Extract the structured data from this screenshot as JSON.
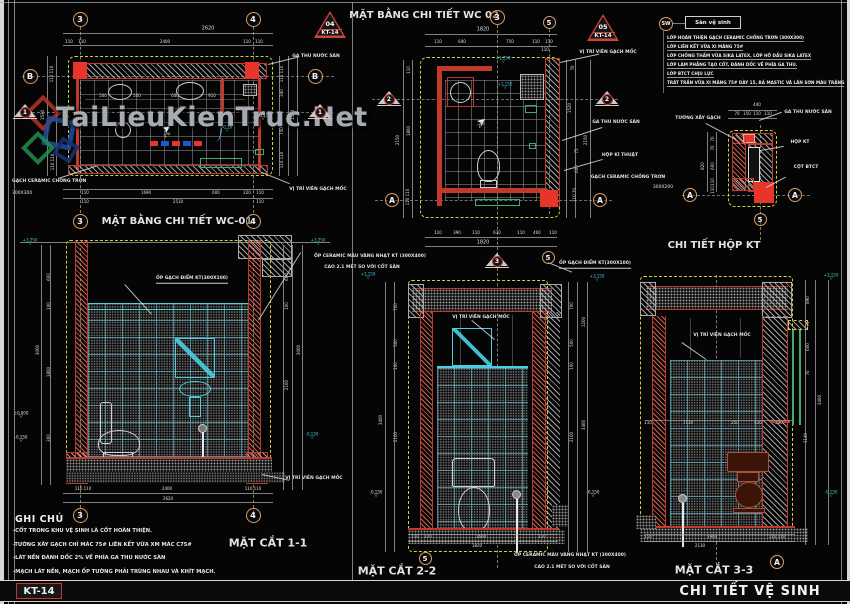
{
  "meta": {
    "sheet_code": "KT-14",
    "sheet_title": "CHI TIẾT VỆ SINH"
  },
  "watermark": {
    "text": "TaiLieuKienTruc.Net"
  },
  "legend": {
    "tag": "SW",
    "box_label": "Sàn vệ sinh",
    "lines": [
      "LỚP HOÀN THIỆN GẠCH CERAMIC CHỐNG TRƠN (300X300)",
      "LỚP LIÊN KẾT VỮA XI MĂNG 75#",
      "LỚP CHỐNG THẤM VỮA SIKA LATEX, LỚP HỒ DẦU SIKA LATEX",
      "LỚP LÀM PHẲNG TẠO CỐT, ĐÁNH DỐC VỀ PHÍA GA THU.",
      "LỚP BTCT CHỊU LỰC",
      "TRÁT TRẦN VỮA XI MĂNG 75# DÀY 15, BẢ MASTIC VÀ LĂN SƠN MÀU TRẮNG"
    ]
  },
  "notes": {
    "heading": "GHI CHÚ",
    "items": [
      "-CỐT TRONG KHU VỆ SINH LÀ CỐT HOÀN THIỆN.",
      "-TƯỜNG XÂY GẠCH CHỈ MÁC 75# LIÊN KẾT VỮA XM MÁC C75#",
      "-LÁT NỀN ĐÁNH DỐC 2% VỀ PHÍA GA THU NƯỚC SÀN",
      "-MẠCH LÁT NỀN, MẠCH ỐP TƯỜNG PHẢI TRÙNG NHAU VÀ KHÍT MẠCH."
    ]
  },
  "bubbles": [
    {
      "k": "c",
      "t": "3",
      "x": 80,
      "y": 19,
      "d": 15
    },
    {
      "k": "c",
      "t": "4",
      "x": 253,
      "y": 19,
      "d": 15
    },
    {
      "k": "c",
      "t": "B",
      "x": 30,
      "y": 76,
      "d": 15
    },
    {
      "k": "c",
      "t": "B",
      "x": 315,
      "y": 76,
      "d": 15
    },
    {
      "k": "c",
      "t": "3",
      "x": 80,
      "y": 221,
      "d": 15
    },
    {
      "k": "c",
      "t": "4",
      "x": 253,
      "y": 221,
      "d": 15
    },
    {
      "k": "t",
      "t": "1",
      "x": 25,
      "y": 112
    },
    {
      "k": "t",
      "t": "1",
      "x": 320,
      "y": 112
    },
    {
      "k": "r",
      "no": "04",
      "sheet": "KT-14",
      "x": 330,
      "y": 24
    },
    {
      "k": "c",
      "t": "3",
      "x": 497,
      "y": 17,
      "d": 15
    },
    {
      "k": "c",
      "t": "5",
      "x": 549,
      "y": 22,
      "d": 13
    },
    {
      "k": "r",
      "no": "05",
      "sheet": "KT-14",
      "x": 603,
      "y": 27
    },
    {
      "k": "t",
      "t": "2",
      "x": 389,
      "y": 99
    },
    {
      "k": "t",
      "t": "2",
      "x": 607,
      "y": 99
    },
    {
      "k": "c",
      "t": "A",
      "x": 392,
      "y": 200,
      "d": 14
    },
    {
      "k": "c",
      "t": "A",
      "x": 600,
      "y": 200,
      "d": 14
    },
    {
      "k": "c",
      "t": "A",
      "x": 690,
      "y": 195,
      "d": 14
    },
    {
      "k": "c",
      "t": "A",
      "x": 795,
      "y": 195,
      "d": 14
    },
    {
      "k": "c",
      "t": "5",
      "x": 760,
      "y": 219,
      "d": 13
    },
    {
      "k": "c",
      "t": "3",
      "x": 80,
      "y": 515,
      "d": 15
    },
    {
      "k": "c",
      "t": "4",
      "x": 253,
      "y": 515,
      "d": 15
    },
    {
      "k": "t",
      "t": "3",
      "x": 497,
      "y": 261
    },
    {
      "k": "c",
      "t": "5",
      "x": 548,
      "y": 257,
      "d": 13
    },
    {
      "k": "c",
      "t": "5",
      "x": 425,
      "y": 558,
      "d": 13
    },
    {
      "k": "c",
      "t": "A",
      "x": 777,
      "y": 562,
      "d": 14
    }
  ],
  "annotations": [
    {
      "t": "MẶT BẰNG CHI TIẾT WC-01",
      "x": 177,
      "y": 222,
      "s": 10,
      "b": 1,
      "n": "title-plan-wc01"
    },
    {
      "t": "2620",
      "x": 208,
      "y": 29
    },
    {
      "t": "110",
      "x": 69,
      "y": 42,
      "s": 4
    },
    {
      "t": "110",
      "x": 82,
      "y": 42,
      "s": 4
    },
    {
      "t": "2400",
      "x": 165,
      "y": 42,
      "s": 4
    },
    {
      "t": "110",
      "x": 247,
      "y": 42,
      "s": 4
    },
    {
      "t": "110",
      "x": 259,
      "y": 42,
      "s": 4
    },
    {
      "t": "500",
      "x": 103,
      "y": 96,
      "s": 4
    },
    {
      "t": "500",
      "x": 137,
      "y": 96,
      "s": 4
    },
    {
      "t": "600",
      "x": 175,
      "y": 96,
      "s": 4
    },
    {
      "t": "910",
      "x": 212,
      "y": 96,
      "s": 4
    },
    {
      "t": "110 110",
      "x": 52,
      "y": 74,
      "s": 4,
      "r": -90
    },
    {
      "t": "1530",
      "x": 43,
      "y": 115,
      "s": 4,
      "r": -90
    },
    {
      "t": "110 110",
      "x": 53,
      "y": 162,
      "s": 4,
      "r": -90
    },
    {
      "t": "110 110",
      "x": 282,
      "y": 74,
      "s": 4,
      "r": -90
    },
    {
      "t": "340",
      "x": 282,
      "y": 93,
      "s": 4,
      "r": -90
    },
    {
      "t": "1530",
      "x": 293,
      "y": 115,
      "s": 4,
      "r": -90
    },
    {
      "t": "750",
      "x": 282,
      "y": 131,
      "s": 4,
      "r": -90
    },
    {
      "t": "110 110",
      "x": 282,
      "y": 160,
      "s": 4,
      "r": -90
    },
    {
      "t": "110",
      "x": 85,
      "y": 193,
      "s": 4
    },
    {
      "t": "1690",
      "x": 146,
      "y": 193,
      "s": 4
    },
    {
      "t": "600",
      "x": 216,
      "y": 193,
      "s": 4
    },
    {
      "t": "220",
      "x": 247,
      "y": 193,
      "s": 4
    },
    {
      "t": "110",
      "x": 260,
      "y": 193,
      "s": 4
    },
    {
      "t": "110",
      "x": 85,
      "y": 202,
      "s": 4
    },
    {
      "t": "2510",
      "x": 178,
      "y": 202,
      "s": 4
    },
    {
      "t": "110",
      "x": 260,
      "y": 202,
      "s": 4
    },
    {
      "t": "GA THU NƯỚC SÀN",
      "x": 316,
      "y": 57,
      "s": 4.5,
      "b": 1,
      "n": "label-ga-thu-nuoc-san"
    },
    {
      "t": "GẠCH CERAMIC CHỐNG TRƠN",
      "x": 12,
      "y": 182,
      "s": 4.5,
      "b": 1,
      "a": "l",
      "n": "label-gach-ceramic"
    },
    {
      "t": "300X300",
      "x": 12,
      "y": 194,
      "s": 4.5,
      "a": "l"
    },
    {
      "t": "VỊ TRÍ VIÊN GẠCH MỐC",
      "x": 318,
      "y": 190,
      "s": 4.5,
      "b": 1,
      "n": "label-vien-gach-moc"
    },
    {
      "t": "-0.20",
      "x": 227,
      "y": 129,
      "s": 4,
      "c": "c",
      "lv": 1
    },
    {
      "t": "-0.15",
      "x": 263,
      "y": 117,
      "s": 4,
      "lv": 1
    },
    {
      "t": "2%",
      "x": 168,
      "y": 136,
      "s": 4.5,
      "r": -35
    },
    {
      "t": "MẶT BẰNG CHI TIẾT WC 02",
      "x": 424,
      "y": 16,
      "s": 10,
      "b": 1,
      "n": "title-plan-wc02"
    },
    {
      "t": "1820",
      "x": 483,
      "y": 30
    },
    {
      "t": "110",
      "x": 438,
      "y": 42,
      "s": 4
    },
    {
      "t": "640",
      "x": 462,
      "y": 42,
      "s": 4
    },
    {
      "t": "750",
      "x": 510,
      "y": 42,
      "s": 4
    },
    {
      "t": "110",
      "x": 536,
      "y": 42,
      "s": 4
    },
    {
      "t": "110",
      "x": 549,
      "y": 42,
      "s": 4
    },
    {
      "t": "110",
      "x": 545,
      "y": 50,
      "s": 4
    },
    {
      "t": "110",
      "x": 409,
      "y": 70,
      "s": 4,
      "r": -90
    },
    {
      "t": "1800",
      "x": 409,
      "y": 131,
      "s": 4,
      "r": -90
    },
    {
      "t": "2150",
      "x": 398,
      "y": 140,
      "s": 4,
      "r": -90
    },
    {
      "t": "110 110",
      "x": 408,
      "y": 197,
      "s": 4,
      "r": -90
    },
    {
      "t": "70",
      "x": 573,
      "y": 68,
      "s": 4,
      "r": -90
    },
    {
      "t": "1520",
      "x": 570,
      "y": 108,
      "s": 4,
      "r": -90
    },
    {
      "t": "2150",
      "x": 586,
      "y": 140,
      "s": 4,
      "r": -90
    },
    {
      "t": "75",
      "x": 577,
      "y": 151,
      "s": 4,
      "r": -90
    },
    {
      "t": "600",
      "x": 577,
      "y": 169,
      "s": 4,
      "r": -90
    },
    {
      "t": "110 70",
      "x": 575,
      "y": 195,
      "s": 4,
      "r": -90
    },
    {
      "t": "110",
      "x": 438,
      "y": 233,
      "s": 4
    },
    {
      "t": "390",
      "x": 457,
      "y": 233,
      "s": 4
    },
    {
      "t": "110",
      "x": 476,
      "y": 233,
      "s": 4
    },
    {
      "t": "630",
      "x": 497,
      "y": 233,
      "s": 4
    },
    {
      "t": "110",
      "x": 521,
      "y": 233,
      "s": 4
    },
    {
      "t": "400",
      "x": 537,
      "y": 233,
      "s": 4
    },
    {
      "t": "110",
      "x": 553,
      "y": 233,
      "s": 4
    },
    {
      "t": "1820",
      "x": 483,
      "y": 243
    },
    {
      "t": "+1.750",
      "x": 503,
      "y": 60,
      "s": 4,
      "c": "c",
      "lv": 1
    },
    {
      "t": "+1.150",
      "x": 505,
      "y": 86,
      "s": 4,
      "c": "c",
      "lv": 1
    },
    {
      "t": "VỊ TRÍ VIÊN GẠCH MỐC",
      "x": 608,
      "y": 53,
      "s": 4.5,
      "b": 1,
      "n": "label-vien-gach-moc"
    },
    {
      "t": "GA THU NƯỚC SÀN",
      "x": 616,
      "y": 123,
      "s": 4.5,
      "b": 1,
      "n": "label-ga-thu-nuoc-san"
    },
    {
      "t": "HỘP KĨ THUẬT",
      "x": 620,
      "y": 156,
      "s": 4.5,
      "b": 1,
      "n": "label-hop-ki-thuat"
    },
    {
      "t": "GẠCH CERAMIC CHỐNG TRƠN",
      "x": 628,
      "y": 178,
      "s": 4.5,
      "b": 1,
      "n": "label-gach-ceramic"
    },
    {
      "t": "300X200",
      "x": 663,
      "y": 188,
      "s": 4.5
    },
    {
      "t": "2%",
      "x": 482,
      "y": 126,
      "s": 4.5,
      "r": -40
    },
    {
      "t": "CHI TIẾT HỘP KT",
      "x": 714,
      "y": 246,
      "s": 10,
      "b": 1,
      "n": "title-detail-hop-kt"
    },
    {
      "t": "440",
      "x": 757,
      "y": 105,
      "s": 4
    },
    {
      "t": "70",
      "x": 737,
      "y": 114,
      "s": 4
    },
    {
      "t": "150",
      "x": 747,
      "y": 114,
      "s": 4
    },
    {
      "t": "110",
      "x": 757,
      "y": 114,
      "s": 4
    },
    {
      "t": "110",
      "x": 768,
      "y": 114,
      "s": 4
    },
    {
      "t": "TƯỜNG XÂY GẠCH",
      "x": 698,
      "y": 119,
      "s": 4.5,
      "b": 1,
      "n": "label-tuong-xay-gach"
    },
    {
      "t": "GA THU NƯỚC SÀN",
      "x": 808,
      "y": 113,
      "s": 4.5,
      "b": 1,
      "n": "label-ga-thu-nuoc-san"
    },
    {
      "t": "HỘP KT",
      "x": 800,
      "y": 143,
      "s": 4.5,
      "b": 1,
      "n": "label-hop-kt"
    },
    {
      "t": "CỘT BTCT",
      "x": 806,
      "y": 168,
      "s": 4.5,
      "b": 1,
      "n": "label-cot-btct"
    },
    {
      "t": "70",
      "x": 713,
      "y": 139,
      "s": 4,
      "r": -90
    },
    {
      "t": "70",
      "x": 713,
      "y": 148,
      "s": 4,
      "r": -90
    },
    {
      "t": "600",
      "x": 713,
      "y": 166,
      "s": 4,
      "r": -90
    },
    {
      "t": "110",
      "x": 713,
      "y": 182,
      "s": 4,
      "r": -90
    },
    {
      "t": "110",
      "x": 713,
      "y": 190,
      "s": 4,
      "r": -90
    },
    {
      "t": "820",
      "x": 703,
      "y": 166,
      "s": 4,
      "r": -90
    },
    {
      "t": "MẶT CẮT 1-1",
      "x": 268,
      "y": 543,
      "s": 11,
      "b": 1,
      "n": "title-section-1-1"
    },
    {
      "t": "+3.750",
      "x": 30,
      "y": 242,
      "s": 4,
      "c": "c",
      "lv": 1
    },
    {
      "t": "+3.750",
      "x": 318,
      "y": 242,
      "s": 4,
      "c": "c",
      "lv": 1
    },
    {
      "t": "ỐP GẠCH ĐIỂM KT(300X100)",
      "x": 192,
      "y": 280,
      "s": 4.5,
      "b": 1,
      "u": 1,
      "n": "label-op-gach-diem"
    },
    {
      "t": "ỐP CERAMIC MÀU VÀNG NHẠT KT (300X400)",
      "x": 370,
      "y": 257,
      "s": 4.5,
      "b": 1,
      "n": "label-op-ceramic"
    },
    {
      "t": "CAO 2.1 MÉT SO VỚI CỐT SÀN",
      "x": 362,
      "y": 268,
      "s": 4.5,
      "b": 1
    },
    {
      "t": "600",
      "x": 49,
      "y": 277,
      "s": 4,
      "r": -90
    },
    {
      "t": "100",
      "x": 49,
      "y": 306,
      "s": 4,
      "r": -90
    },
    {
      "t": "3000",
      "x": 38,
      "y": 350,
      "s": 4,
      "r": -90
    },
    {
      "t": "1800",
      "x": 49,
      "y": 372,
      "s": 4,
      "r": -90
    },
    {
      "t": "300",
      "x": 49,
      "y": 438,
      "s": 4,
      "r": -90
    },
    {
      "t": "600",
      "x": 287,
      "y": 277,
      "s": 4,
      "r": -90
    },
    {
      "t": "100",
      "x": 287,
      "y": 306,
      "s": 4,
      "r": -90
    },
    {
      "t": "3000",
      "x": 299,
      "y": 350,
      "s": 4,
      "r": -90
    },
    {
      "t": "2100",
      "x": 287,
      "y": 385,
      "s": 4,
      "r": -90
    },
    {
      "t": "±0.000",
      "x": 21,
      "y": 415,
      "s": 4,
      "lv": 1
    },
    {
      "t": "-0.150",
      "x": 21,
      "y": 439,
      "s": 4,
      "lv": 1
    },
    {
      "t": "-0.150",
      "x": 312,
      "y": 436,
      "s": 4,
      "c": "c",
      "lv": 1
    },
    {
      "t": "VỊ TRÍ VIÊN GẠCH MỐC",
      "x": 314,
      "y": 479,
      "s": 4.5,
      "b": 1,
      "n": "label-vien-gach-moc"
    },
    {
      "t": "110 110",
      "x": 83,
      "y": 489,
      "s": 4
    },
    {
      "t": "2400",
      "x": 167,
      "y": 489,
      "s": 4
    },
    {
      "t": "110 110",
      "x": 253,
      "y": 489,
      "s": 4
    },
    {
      "t": "2620",
      "x": 168,
      "y": 499,
      "s": 4
    },
    {
      "t": "MẶT CẮT 2-2",
      "x": 397,
      "y": 571,
      "s": 11,
      "b": 1,
      "n": "title-section-2-2"
    },
    {
      "t": "ỐP GẠCH ĐIỂM KT(300X100)",
      "x": 595,
      "y": 265,
      "s": 4.5,
      "b": 1,
      "u": 1,
      "n": "label-op-gach-diem"
    },
    {
      "t": "+3.150",
      "x": 597,
      "y": 278,
      "s": 4,
      "c": "c",
      "lv": 1
    },
    {
      "t": "+3.150",
      "x": 368,
      "y": 276,
      "s": 4,
      "c": "c",
      "lv": 1
    },
    {
      "t": "700",
      "x": 396,
      "y": 307,
      "s": 4,
      "r": -90
    },
    {
      "t": "500",
      "x": 396,
      "y": 343,
      "s": 4,
      "r": -90
    },
    {
      "t": "100",
      "x": 396,
      "y": 366,
      "s": 4,
      "r": -90
    },
    {
      "t": "3400",
      "x": 381,
      "y": 420,
      "s": 4,
      "r": -90
    },
    {
      "t": "2100",
      "x": 396,
      "y": 437,
      "s": 4,
      "r": -90
    },
    {
      "t": "700",
      "x": 572,
      "y": 306,
      "s": 4,
      "r": -90
    },
    {
      "t": "1200",
      "x": 584,
      "y": 322,
      "s": 4,
      "r": -90
    },
    {
      "t": "500",
      "x": 572,
      "y": 343,
      "s": 4,
      "r": -90
    },
    {
      "t": "100",
      "x": 572,
      "y": 366,
      "s": 4,
      "r": -90
    },
    {
      "t": "3400",
      "x": 584,
      "y": 425,
      "s": 4,
      "r": -90
    },
    {
      "t": "2100",
      "x": 572,
      "y": 437,
      "s": 4,
      "r": -90
    },
    {
      "t": "-0.150",
      "x": 376,
      "y": 494,
      "s": 4,
      "lv": 1
    },
    {
      "t": "-0.150",
      "x": 593,
      "y": 494,
      "s": 4,
      "lv": 1
    },
    {
      "t": "VỊ TRÍ VIÊN GẠCH MỐC",
      "x": 481,
      "y": 318,
      "s": 4.5,
      "b": 1,
      "n": "label-vien-gach-moc"
    },
    {
      "t": "110",
      "x": 415,
      "y": 537,
      "s": 4
    },
    {
      "t": "110",
      "x": 428,
      "y": 537,
      "s": 4
    },
    {
      "t": "1600",
      "x": 481,
      "y": 537,
      "s": 4
    },
    {
      "t": "110",
      "x": 542,
      "y": 537,
      "s": 4
    },
    {
      "t": "1820",
      "x": 477,
      "y": 546,
      "s": 4
    },
    {
      "t": "ỐP CERAMIC MÀU VÀNG NHẠT KT (300X400)",
      "x": 570,
      "y": 556,
      "s": 4.5,
      "b": 1,
      "n": "label-op-ceramic"
    },
    {
      "t": "CAO 2.1 MÉT SO VỚI CỐT SÀN",
      "x": 572,
      "y": 568,
      "s": 4.5,
      "b": 1
    },
    {
      "t": "MẶT CẮT 3-3",
      "x": 714,
      "y": 570,
      "s": 11,
      "b": 1,
      "n": "title-section-3-3"
    },
    {
      "t": "+3.150",
      "x": 831,
      "y": 277,
      "s": 4,
      "c": "c",
      "lv": 1
    },
    {
      "t": "890",
      "x": 808,
      "y": 300,
      "s": 4,
      "r": -90
    },
    {
      "t": "70",
      "x": 808,
      "y": 324,
      "s": 4,
      "r": -90
    },
    {
      "t": "600",
      "x": 808,
      "y": 347,
      "s": 4,
      "r": -90
    },
    {
      "t": "70",
      "x": 808,
      "y": 373,
      "s": 4,
      "r": -90
    },
    {
      "t": "3400",
      "x": 820,
      "y": 400,
      "s": 4,
      "r": -90
    },
    {
      "t": "1140",
      "x": 806,
      "y": 438,
      "s": 4,
      "r": -90
    },
    {
      "t": "-0.150",
      "x": 831,
      "y": 494,
      "s": 4,
      "c": "c",
      "lv": 1
    },
    {
      "t": "VỊ TRÍ VIÊN GẠCH MỐC",
      "x": 722,
      "y": 336,
      "s": 4.5,
      "b": 1,
      "n": "label-vien-gach-moc"
    },
    {
      "t": "110",
      "x": 648,
      "y": 423,
      "s": 4
    },
    {
      "t": "1130",
      "x": 688,
      "y": 423,
      "s": 4
    },
    {
      "t": "250",
      "x": 735,
      "y": 423,
      "s": 4
    },
    {
      "t": "420",
      "x": 758,
      "y": 423,
      "s": 4
    },
    {
      "t": "220",
      "x": 779,
      "y": 423,
      "s": 4
    },
    {
      "t": "110",
      "x": 648,
      "y": 537,
      "s": 4
    },
    {
      "t": "1900",
      "x": 712,
      "y": 537,
      "s": 4
    },
    {
      "t": "110 110",
      "x": 777,
      "y": 537,
      "s": 4
    },
    {
      "t": "2130",
      "x": 700,
      "y": 546,
      "s": 4
    }
  ]
}
